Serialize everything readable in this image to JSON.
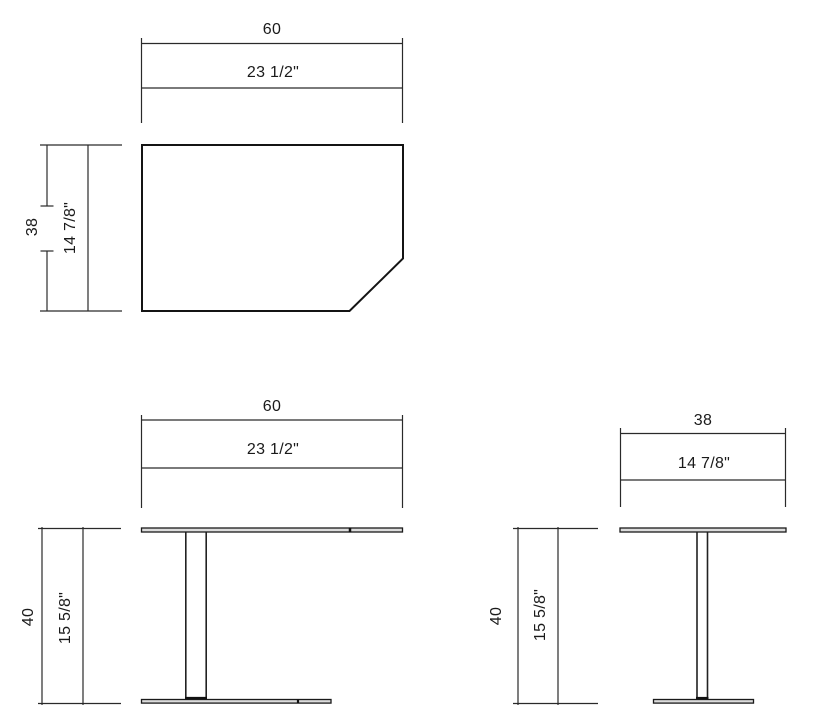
{
  "colors": {
    "line": "#1a1a1a",
    "panel_fill": "#dcdcdc",
    "background": "#ffffff"
  },
  "views": {
    "top": {
      "width_cm": "60",
      "width_in": "23 1/2\"",
      "depth_cm": "38",
      "depth_in": "14 7/8\""
    },
    "front": {
      "width_cm": "60",
      "width_in": "23 1/2\"",
      "height_cm": "40",
      "height_in": "15 5/8\""
    },
    "side": {
      "depth_cm": "38",
      "depth_in": "14 7/8\"",
      "height_cm": "40",
      "height_in": "15 5/8\""
    }
  }
}
